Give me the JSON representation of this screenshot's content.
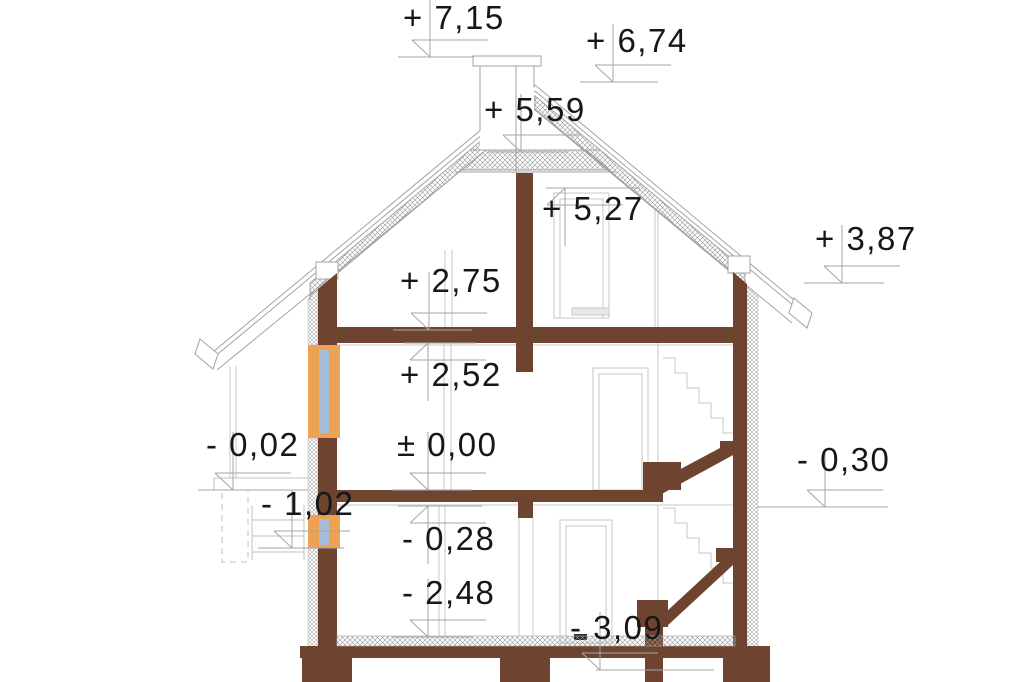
{
  "drawing": {
    "title": "house-cross-section",
    "units": "meters",
    "colors": {
      "wall_fill": "#6e4431",
      "window_frame": "#eda153",
      "window_glass": "#a6bddb",
      "outline": "#a3a3a3",
      "faint_line": "#c7c7c7",
      "marker_line": "#a6a6a6",
      "text": "#171717",
      "background": "#ffffff"
    },
    "elevation_markers": [
      {
        "id": "chimney-top",
        "label": "+ 7,15",
        "value": 7.15,
        "x": 430,
        "y": 57,
        "variant": "above",
        "tx": 403,
        "ty": 2,
        "lx1": 398,
        "lx2": 474
      },
      {
        "id": "ridge",
        "label": "+ 6,74",
        "value": 6.74,
        "x": 613,
        "y": 82,
        "variant": "above",
        "tx": 586,
        "ty": 25,
        "lx1": 580,
        "lx2": 658
      },
      {
        "id": "collar-ceiling",
        "label": "+ 5,59",
        "value": 5.59,
        "x": 521,
        "y": 152,
        "variant": "above",
        "tx": 484,
        "ty": 94,
        "lx1": 488,
        "lx2": 568
      },
      {
        "id": "attic-ceiling",
        "label": "+ 5,27",
        "value": 5.27,
        "x": 565,
        "y": 188,
        "variant": "below",
        "tx": 542,
        "ty": 193,
        "lx1": 546,
        "lx2": 640
      },
      {
        "id": "right-eave",
        "label": "+ 3,87",
        "value": 3.87,
        "x": 842,
        "y": 283,
        "variant": "above",
        "tx": 815,
        "ty": 223,
        "lx1": 804,
        "lx2": 884
      },
      {
        "id": "attic-floor",
        "label": "+ 2,75",
        "value": 2.75,
        "x": 429,
        "y": 330,
        "variant": "above",
        "tx": 400,
        "ty": 265,
        "lx1": 393,
        "lx2": 472
      },
      {
        "id": "ground-ceiling",
        "label": "+ 2,52",
        "value": 2.52,
        "x": 428,
        "y": 343,
        "variant": "below",
        "tx": 400,
        "ty": 359,
        "lx1": 404,
        "lx2": 476
      },
      {
        "id": "ground-floor",
        "label": "± 0,00",
        "value": 0.0,
        "x": 428,
        "y": 490,
        "variant": "above",
        "tx": 397,
        "ty": 429,
        "lx1": 392,
        "lx2": 472
      },
      {
        "id": "left-grade",
        "label": "- 0,02",
        "value": -0.02,
        "x": 233,
        "y": 490,
        "variant": "above",
        "tx": 206,
        "ty": 429,
        "lx1": 198,
        "lx2": 308
      },
      {
        "id": "basement-ceiling",
        "label": "- 0,28",
        "value": -0.28,
        "x": 428,
        "y": 506,
        "variant": "below",
        "tx": 402,
        "ty": 523,
        "lx1": 398,
        "lx2": 482
      },
      {
        "id": "left-lightwell",
        "label": "- 1,02",
        "value": -1.02,
        "x": 292,
        "y": 548,
        "variant": "above",
        "tx": 261,
        "ty": 488,
        "lx1": 258,
        "lx2": 344
      },
      {
        "id": "right-grade",
        "label": "- 0,30",
        "value": -0.3,
        "x": 825,
        "y": 507,
        "variant": "above",
        "tx": 797,
        "ty": 444,
        "lx1": 757,
        "lx2": 888
      },
      {
        "id": "basement-floor",
        "label": "- 2,48",
        "value": -2.48,
        "x": 428,
        "y": 637,
        "variant": "above",
        "tx": 402,
        "ty": 577,
        "lx1": 392,
        "lx2": 472
      },
      {
        "id": "foundation",
        "label": "- 3,09",
        "value": -3.09,
        "x": 600,
        "y": 670,
        "variant": "above",
        "tx": 570,
        "ty": 612,
        "lx1": 596,
        "lx2": 714
      }
    ]
  }
}
